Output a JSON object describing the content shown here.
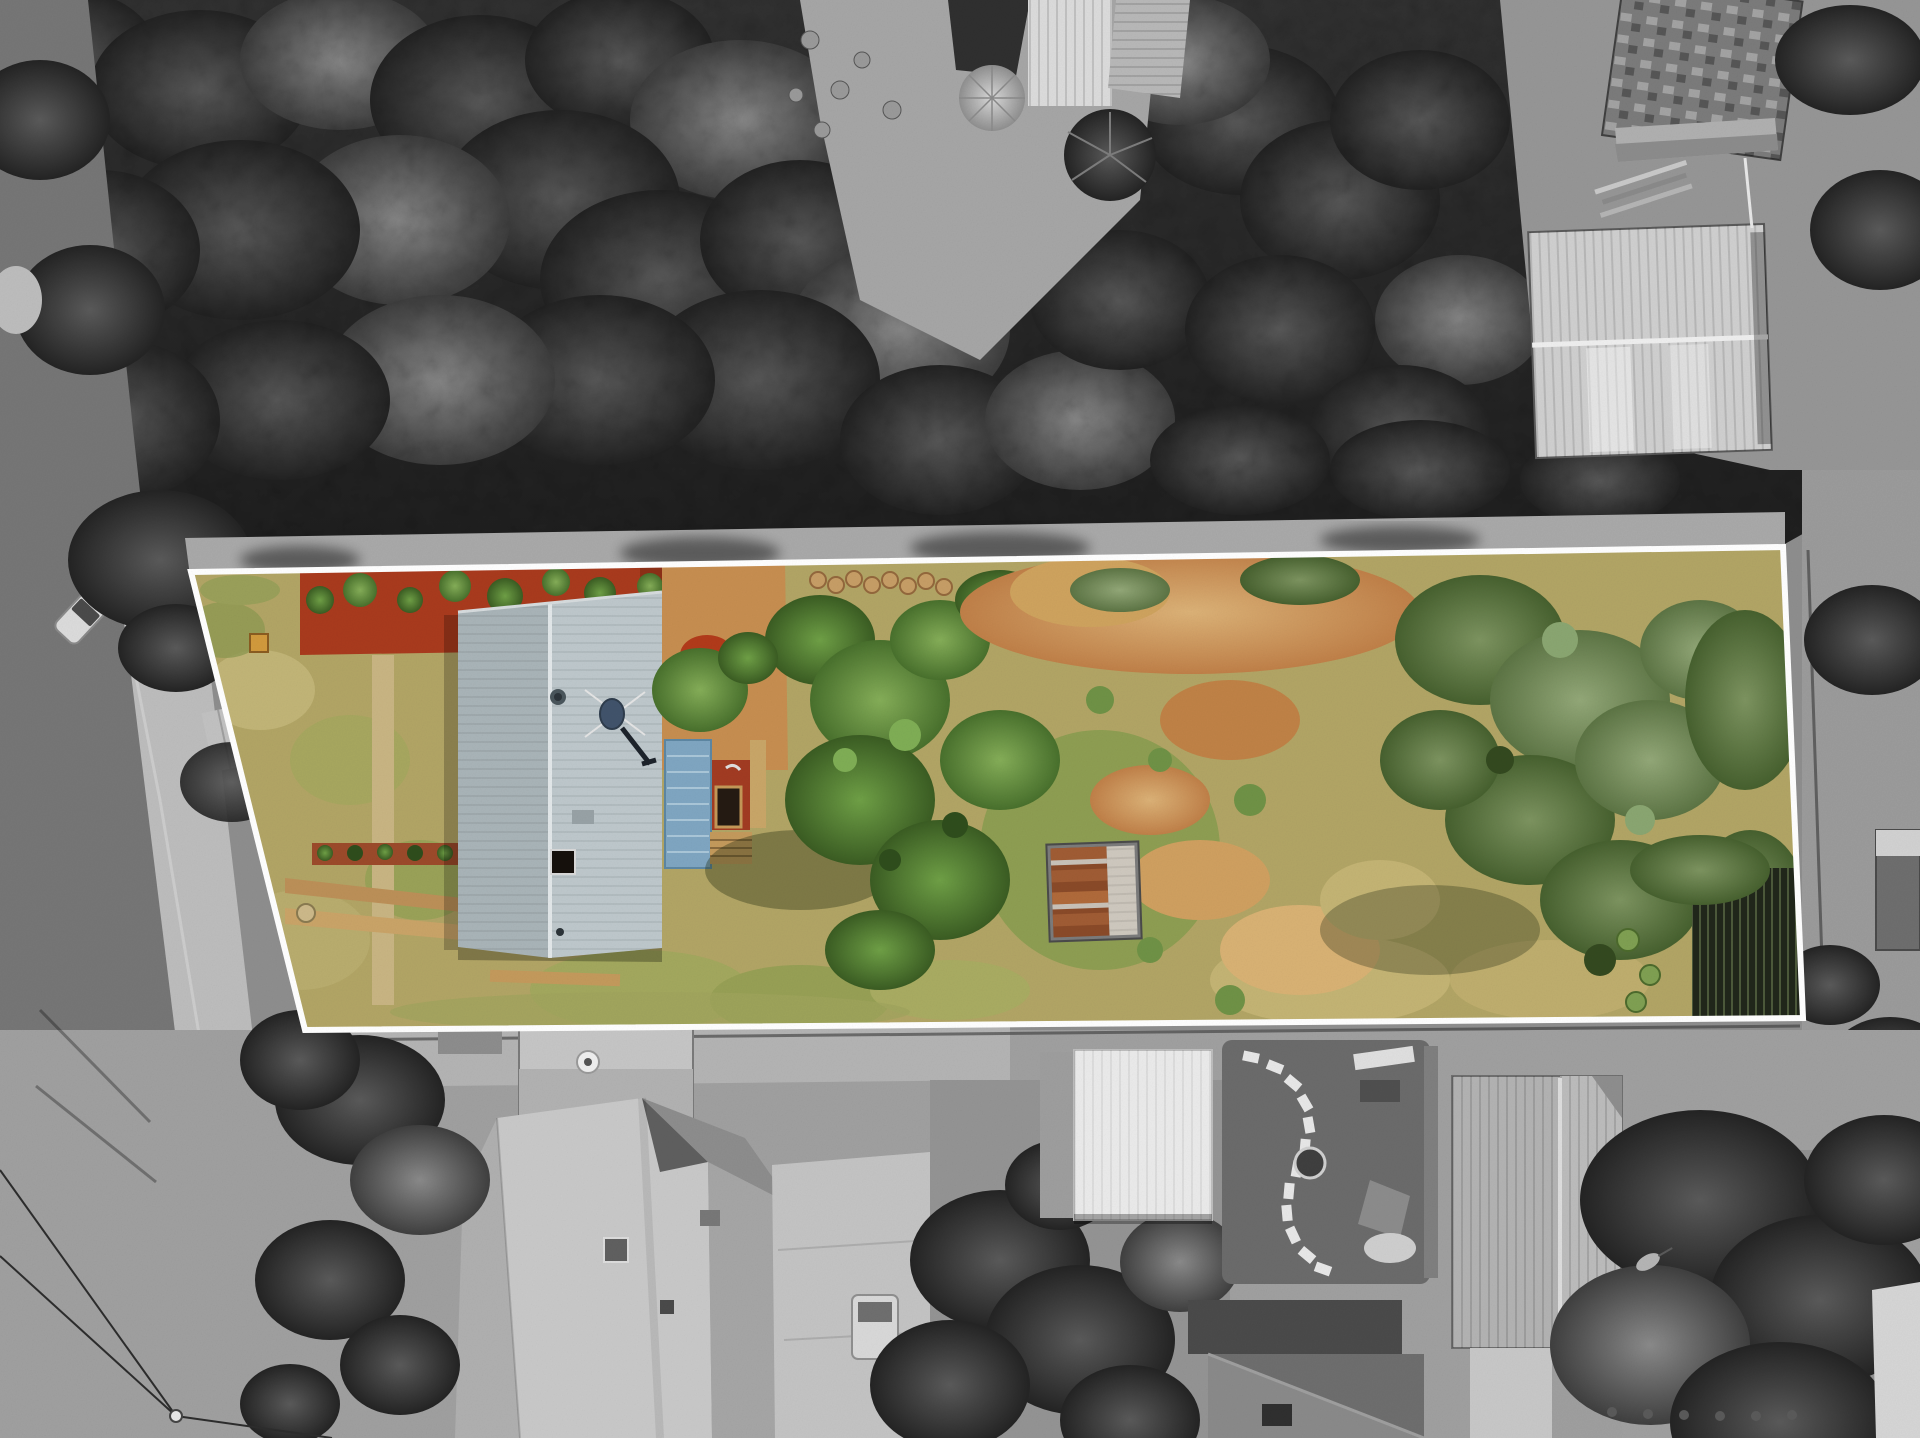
{
  "scene": {
    "kind": "aerial-drone-photograph",
    "treatment": "property lot shown in colour, surroundings desaturated to black-and-white",
    "boundary_overlay": "white outlined quadrilateral around the listed lot"
  },
  "boundary": {
    "points": "191,572 1783,547 1803,1018 305,1030",
    "stroke_width": 6
  },
  "colors": {
    "boundary_white": "#ffffff",
    "bw_base": "#8e8e8e",
    "bw_forest": "#2a2a2a",
    "bw_road": "#767676",
    "bw_footpath": "#bdbdbd",
    "bw_bottom": "#a0a0a0",
    "bw_roof_light": "#c9c9c9",
    "bw_roof_mid": "#a8a8a8",
    "bw_roof_dark": "#4a4a4a",
    "bw_shed_silver": "#d0d0d0",
    "lawn_tan": "#b2a565",
    "lawn_green": "#95994f",
    "lawn_light": "#c6b97c",
    "mulch_red": "#a93a1d",
    "dirt_orange": "#c78e50",
    "dry_grass": "#c4b474",
    "house_roof_left": "#a9b4b8",
    "house_roof_right": "#bec8cc",
    "roof_ridge": "#e3e8ea",
    "dish_blue": "#41536b",
    "pergola_blue": "#7fa6c2",
    "deck_red": "#a23b22",
    "spa_dark": "#241a12",
    "timber": "#c49a5c",
    "tree_green": "#4e7a2e",
    "tree_green_light": "#6d9a42",
    "olive_green": "#5d7a42",
    "shed_rust": "#a05c34",
    "fence_dark": "#20261a",
    "path_tan": "#c9b583"
  }
}
